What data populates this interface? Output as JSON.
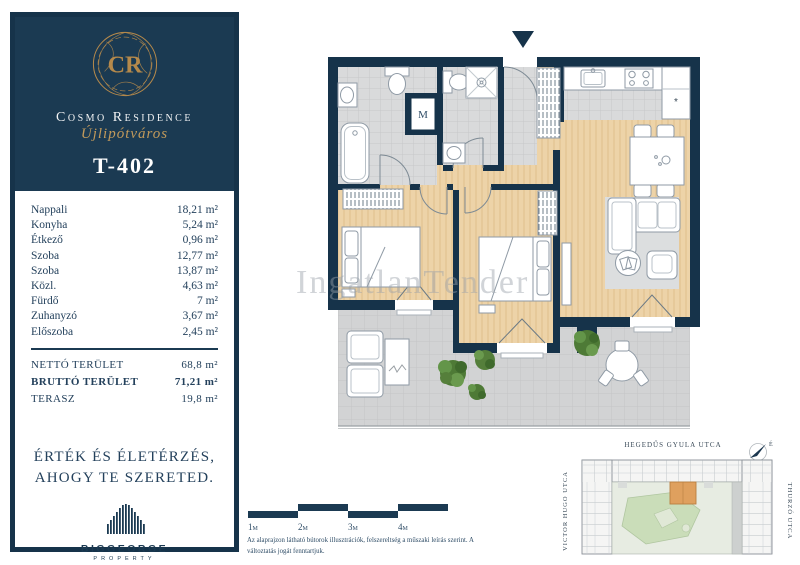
{
  "watermark": "IngatlanTender",
  "sidebar": {
    "monogram": "CR",
    "brand": "Cosmo Residence",
    "brand_sub": "Újlipótváros",
    "unit_id": "T-402",
    "rooms": [
      {
        "name": "Nappali",
        "area": "18,21 m²"
      },
      {
        "name": "Konyha",
        "area": "5,24 m²"
      },
      {
        "name": "Étkező",
        "area": "0,96 m²"
      },
      {
        "name": "Szoba",
        "area": "12,77 m²"
      },
      {
        "name": "Szoba",
        "area": "13,87 m²"
      },
      {
        "name": "Közl.",
        "area": "4,63 m²"
      },
      {
        "name": "Fürdő",
        "area": "7 m²"
      },
      {
        "name": "Zuhanyzó",
        "area": "3,67 m²"
      },
      {
        "name": "Előszoba",
        "area": "2,45 m²"
      }
    ],
    "totals": [
      {
        "label": "NETTÓ TERÜLET",
        "value": "68,8 m²"
      },
      {
        "label": "BRUTTÓ TERÜLET",
        "value": "71,21 m²"
      },
      {
        "label": "TERASZ",
        "value": "19,8 m²"
      }
    ],
    "slogan_line1": "ÉRTÉK ÉS ÉLETÉRZÉS,",
    "slogan_line2": "AHOGY TE SZERETED.",
    "developer_name": "BIGGEORGE",
    "developer_sub": "PROPERTY"
  },
  "plan": {
    "room_label_m": "M",
    "fridge_symbol": "*",
    "scale_labels": [
      "1m",
      "2m",
      "3m",
      "4m"
    ],
    "disclaimer_line1": "Az alaprajzon látható bútorok illusztrációk, felszereltség a műszaki leírás szerint.",
    "disclaimer_line2": "A változtatás jogát fenntartjuk."
  },
  "sitemap": {
    "street_top": "HEGEDŰS GYULA UTCA",
    "street_left": "VICTOR HUGO UTCA",
    "street_right": "THURZÓ UTCA",
    "compass": "É"
  },
  "colors": {
    "navy": "#16334a",
    "gold": "#b5894b",
    "wood": "#edd3a8",
    "tile": "#d9dadb",
    "terrace": "#d2d3d4",
    "highlight_unit": "#dfa05e",
    "courtyard_green": "#caddb9"
  }
}
